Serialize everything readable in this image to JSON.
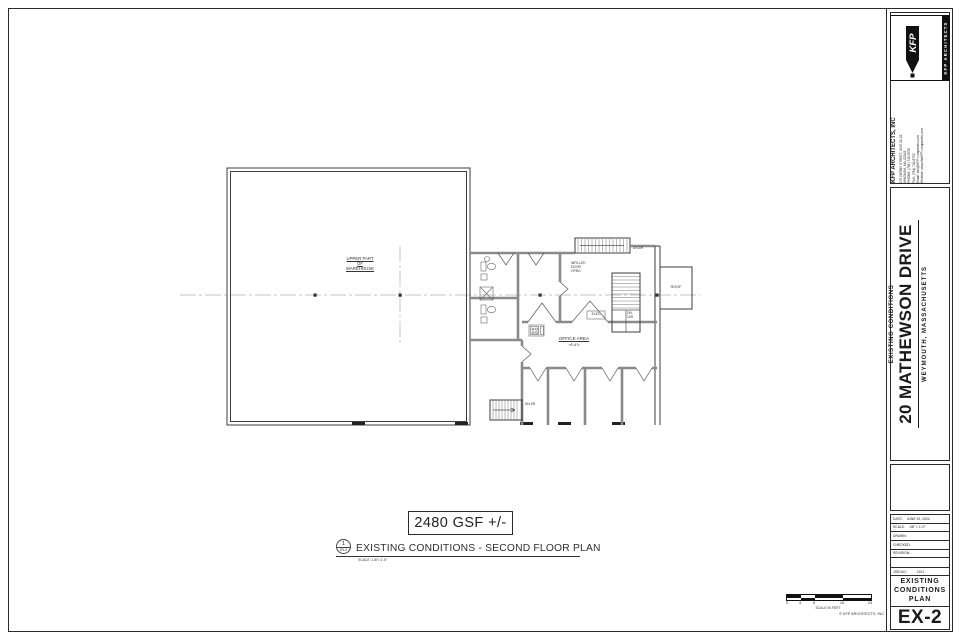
{
  "sheet": {
    "firm": {
      "logo_kfp": "KFP",
      "logo_strip": "KFP ARCHITECTS",
      "name": "KFP ARCHITECTS, INC",
      "address_lines": [
        "175 DERBY STREET, UNIT 21-22",
        "HINGHAM, MA, 02043",
        "PHONE: (781) 740-8750",
        "FAX: (781) 740-8752",
        "Email: info@KFP-companies.com",
        "Website: www.theKFP-companies.com"
      ]
    },
    "project": {
      "phase": "EXISTING CONDITIONS",
      "name": "20 MATHEWSON DRIVE",
      "location": "WEYMOUTH, MASSACHUSETTS"
    },
    "titleblock": {
      "date_label": "DATE:",
      "date": "JUNE 19, 2022",
      "scale_label": "SCALE:",
      "scale": "1/8\" = 1'-0\"",
      "drawn_label": "DRAWN:",
      "drawn": "",
      "checked_label": "CHECKED:",
      "checked": "",
      "revision_label": "REVISION:",
      "revision": "",
      "job_label": "JOB NO:",
      "job_no": "2101",
      "sheet_title_1": "EXISTING",
      "sheet_title_2": "CONDITIONS",
      "sheet_title_3": "PLAN",
      "sheet_no": "EX-2"
    }
  },
  "drawing": {
    "gsf": "2480 GSF +/-",
    "bubble_no": "1",
    "bubble_sheet": "EX-2",
    "title": "EXISTING CONDITIONS - SECOND FLOOR PLAN",
    "title_scale": "SCALE: 1/8\"=1'-0\"",
    "labels": {
      "warehouse_1": "UPPER PART",
      "warehouse_2": "OF",
      "warehouse_3": "WAREHOUSE",
      "office": "OFFICE AREA",
      "office_sub": "+8'-6\"±",
      "roof": "ROOF",
      "elec": "ELEC",
      "infilled_1": "INFILLED",
      "infilled_2": "DOOR",
      "infilled_3": "OPNG",
      "stair_top": "DN-6R",
      "stair_right_1": "DN-",
      "stair_right_2": "14R",
      "stair_bottom": "DN-6R"
    },
    "scalebar": {
      "t0": "0",
      "t1": "4",
      "t2": "8",
      "t3": "16",
      "t4": "24",
      "caption": "SCALE IN FEET"
    },
    "copyright": "© KFP ARCHITECTS, INC"
  }
}
